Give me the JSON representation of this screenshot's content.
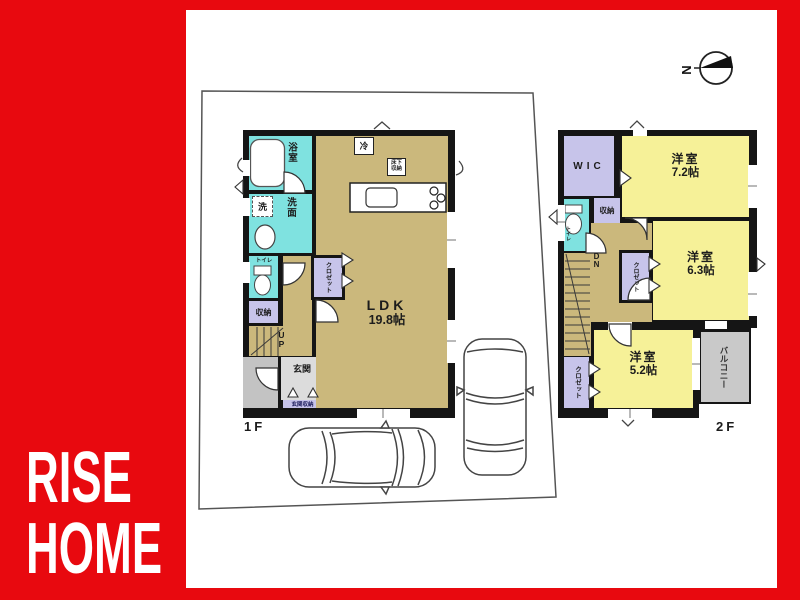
{
  "brand": {
    "line1": "RISE",
    "line2": "HOME"
  },
  "compass": {
    "north": "N"
  },
  "f1": {
    "label": "1F",
    "ldk_name": "LDK",
    "ldk_size": "19.8帖",
    "bath": "浴室",
    "washroom": "洗面",
    "washer": "洗",
    "toilet": "トイレ",
    "storage": "収納",
    "closet": "クロゼット",
    "up": "UP",
    "entrance": "玄関",
    "entrance_storage": "玄関収納",
    "fridge": "冷",
    "underfloor_l1": "床下",
    "underfloor_l2": "収納"
  },
  "f2": {
    "label": "2F",
    "wic": "WIC",
    "bed1_name": "洋室",
    "bed1_size": "7.2帖",
    "bed2_name": "洋室",
    "bed2_size": "6.3帖",
    "bed3_name": "洋室",
    "bed3_size": "5.2帖",
    "toilet": "トイレ",
    "storage": "収納",
    "closet_a": "クロゼット",
    "closet_b": "クロゼット",
    "dn": "DN",
    "balcony": "バルコニー"
  },
  "colors": {
    "background_red": "#e8090f",
    "floor_tan": "#cbb87c",
    "wet_cyan": "#7fe2e0",
    "closet_lavender": "#c7c4ea",
    "bedroom_yellow": "#f6f198",
    "balcony_gray": "#c9c9c9",
    "wall_black": "#151515"
  }
}
